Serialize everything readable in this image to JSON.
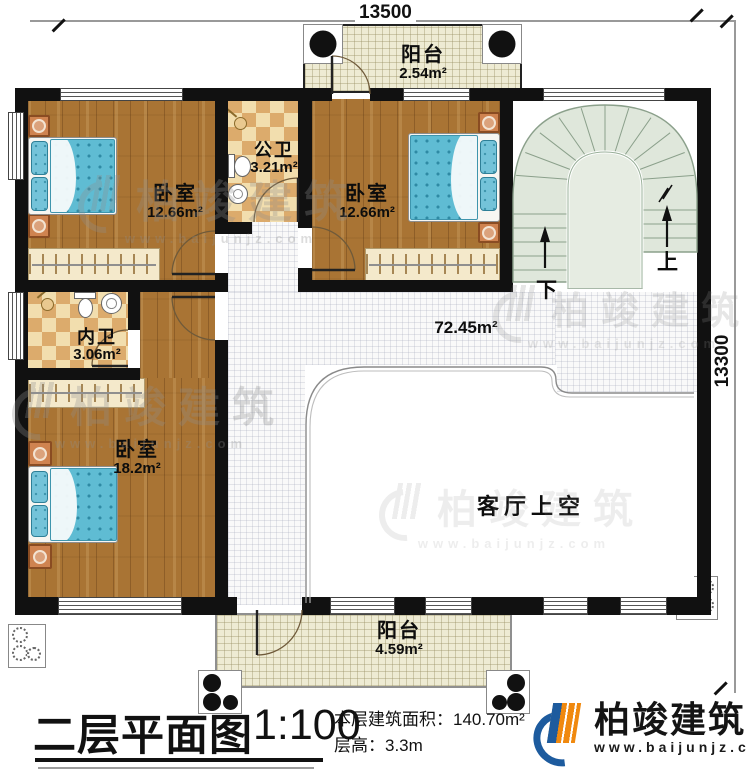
{
  "dims": {
    "width_label": "13500",
    "height_label": "13300"
  },
  "rooms": {
    "balcony_top": {
      "name": "阳台",
      "area": "2.54m²"
    },
    "bedroom1": {
      "name": "卧室",
      "area": "12.66m²"
    },
    "public_bath": {
      "name": "公卫",
      "area": "3.21m²"
    },
    "bedroom2": {
      "name": "卧室",
      "area": "12.66m²"
    },
    "inner_bath": {
      "name": "内卫",
      "area": "3.06m²"
    },
    "bedroom3": {
      "name": "卧室",
      "area": "18.2m²"
    },
    "hall": {
      "area": "72.45m²"
    },
    "living_void": {
      "name": "客厅上空"
    },
    "balcony_bottom": {
      "name": "阳台",
      "area": "4.59m²"
    }
  },
  "stairs": {
    "up_label": "上",
    "down_label": "下"
  },
  "footer": {
    "title": "二层平面图",
    "scale": "1:100",
    "area_label": "本层建筑面积：",
    "area_value": "140.70m²",
    "height_label": "层高：",
    "height_value": "3.3m",
    "brand": "柏竣建筑",
    "website": "www.baijunjz.com"
  },
  "watermark": {
    "brand": "柏竣建筑",
    "website": "www.baijunjz.com"
  },
  "colors": {
    "wall": "#111111",
    "wood": "#a97434",
    "tile_light": "#f2deae",
    "tile_dark": "#dcab6c",
    "balcony": "#eeebd3",
    "stair": "#dfe7db",
    "bed": "#5fbcd3",
    "logo_blue": "#1d5b9e",
    "logo_orange": "#f0890f"
  }
}
